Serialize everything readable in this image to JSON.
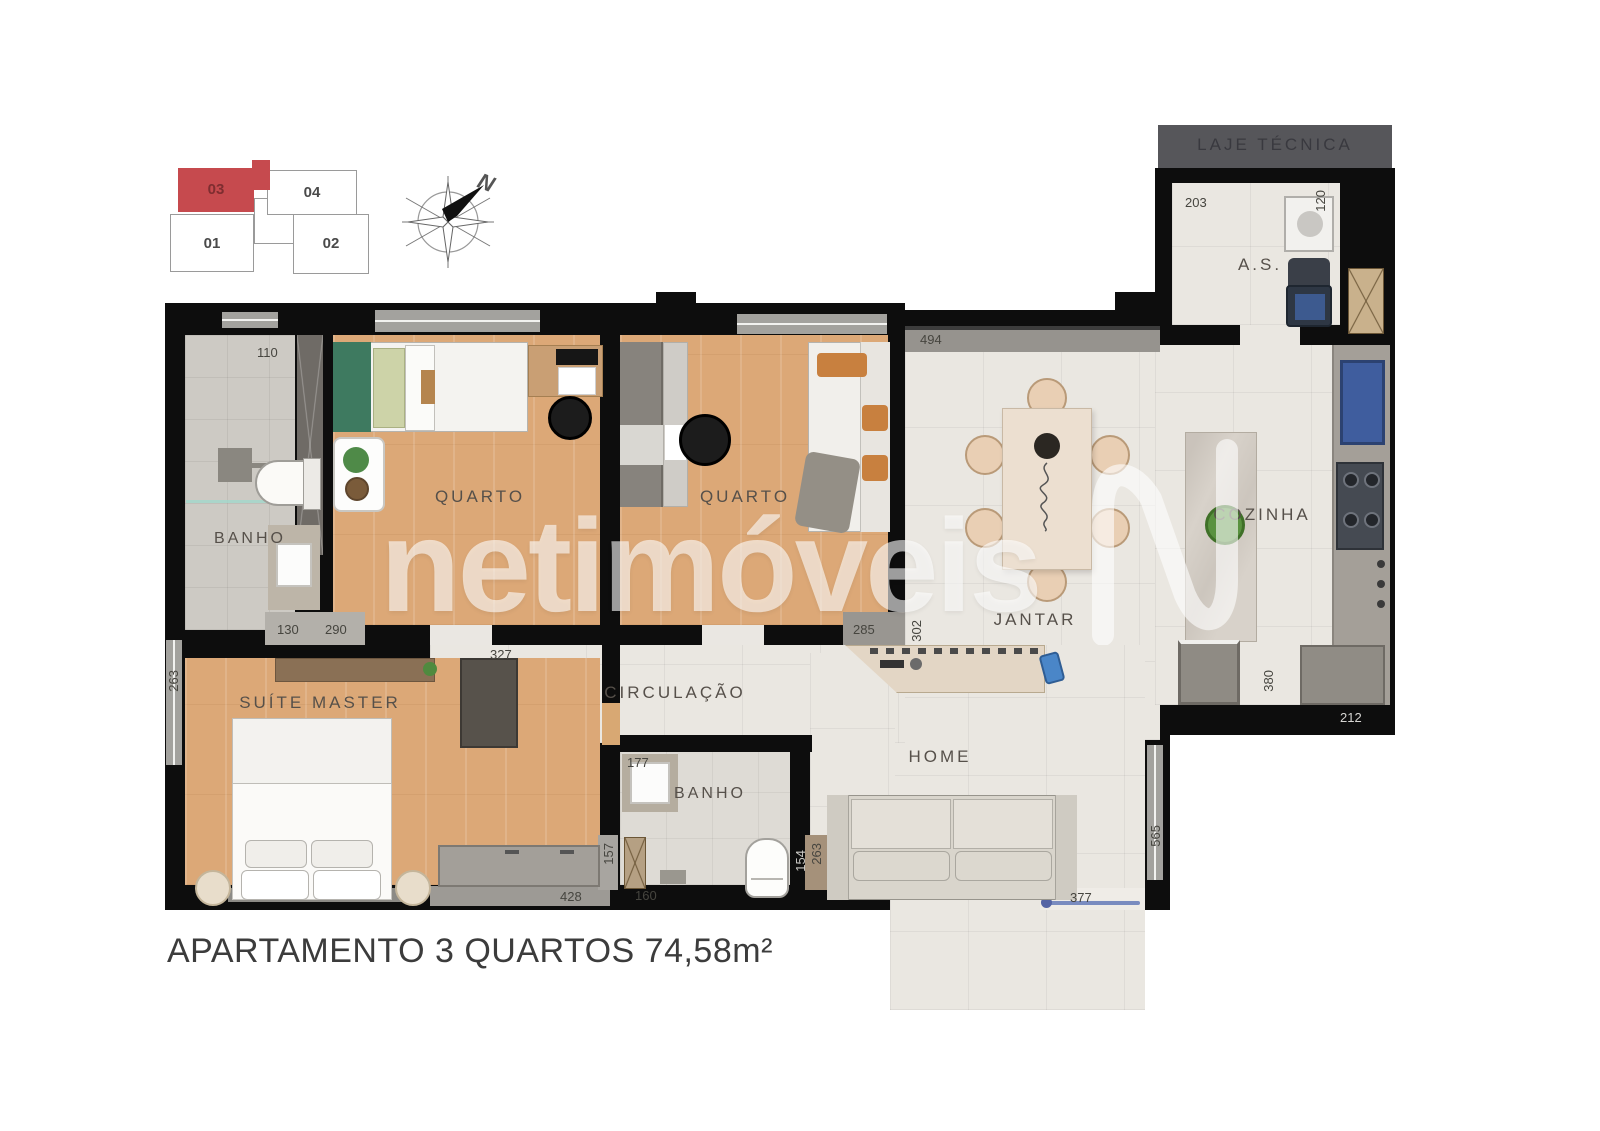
{
  "title": "APARTAMENTO 3 QUARTOS 74,58m²",
  "watermark": "netimóveis",
  "laje_tecnica_label": "LAJE TÉCNICA",
  "compass": {
    "north": "N"
  },
  "key_plan": {
    "u01": "01",
    "u02": "02",
    "u03": "03",
    "u04": "04",
    "highlight_color": "#c64a4e"
  },
  "rooms": {
    "banho1": "BANHO",
    "quarto1": "QUARTO",
    "quarto2": "QUARTO",
    "jantar": "JANTAR",
    "cozinha": "COZINHA",
    "as": "A.S.",
    "suite": "SUÍTE MASTER",
    "circulacao": "CIRCULAÇÃO",
    "banho2": "BANHO",
    "home": "HOME"
  },
  "dims": {
    "d110": "110",
    "d130": "130",
    "d290": "290",
    "d263L": "263",
    "d327": "327",
    "d157": "157",
    "d428": "428",
    "d160": "160",
    "d154": "154",
    "d263H": "263",
    "d377": "377",
    "d565": "565",
    "d285": "285",
    "d302": "302",
    "d494": "494",
    "d203": "203",
    "d120": "120",
    "d380": "380",
    "d212": "212",
    "d177": "177"
  },
  "colors": {
    "wall": "#0d0d0d",
    "wood_floor": "#dca877",
    "tile_floor": "#eae7e1",
    "bath_floor": "#cdcac4",
    "laje_band": "#56565a",
    "unit_highlight": "#c64a4e",
    "entry_door_blue": "#7a8cc0"
  }
}
